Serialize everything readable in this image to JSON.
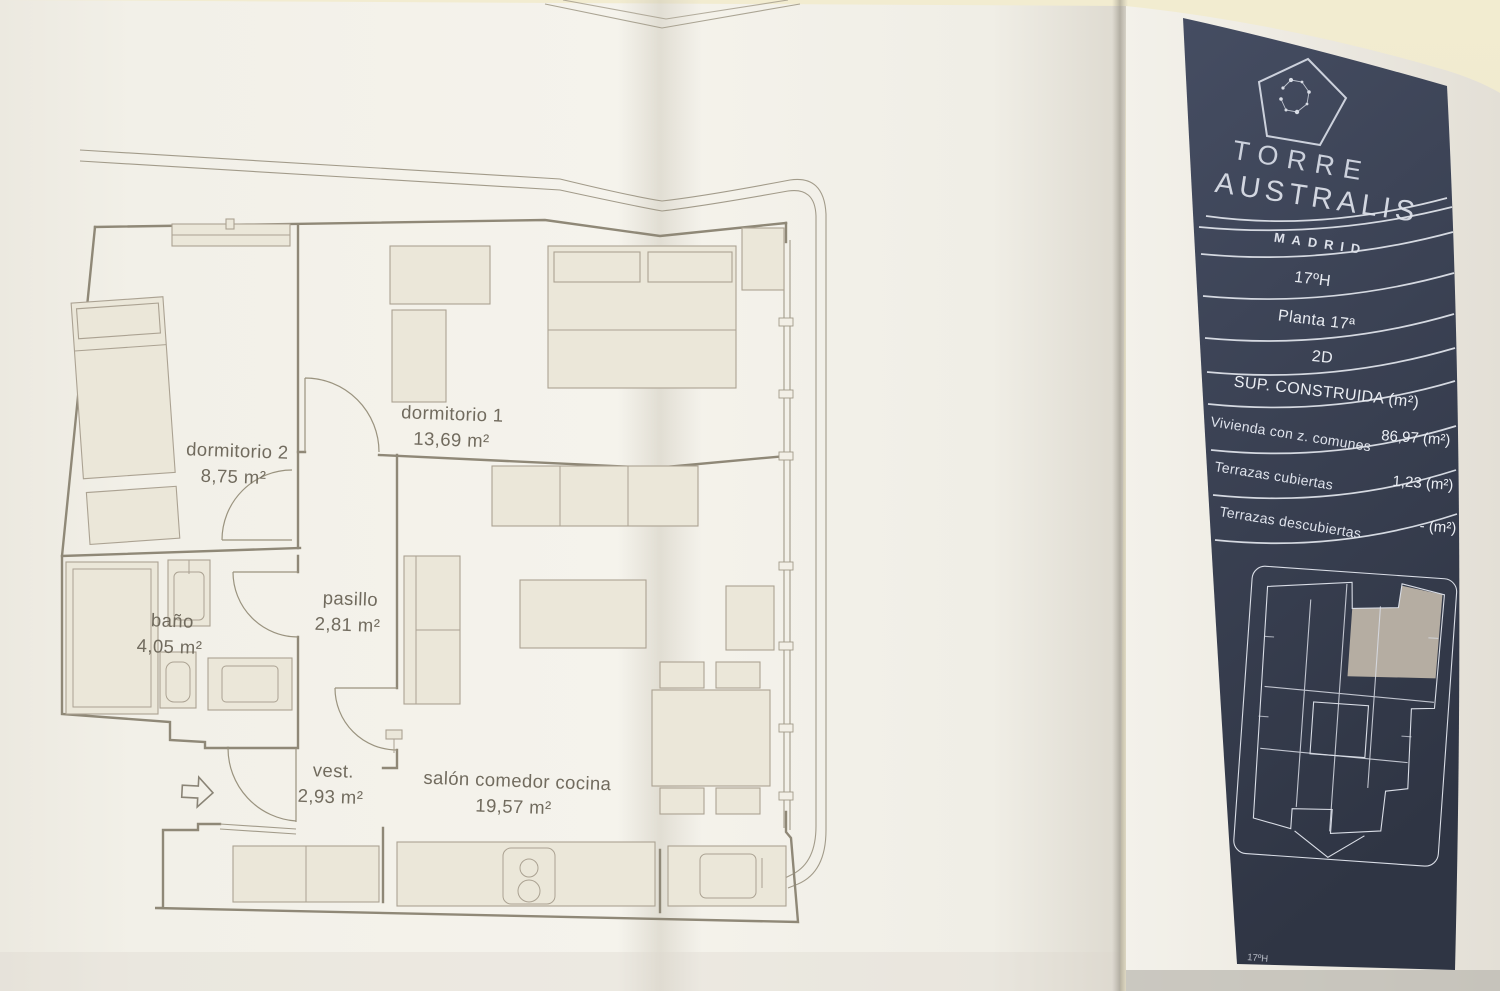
{
  "floorplan": {
    "rooms": [
      {
        "name": "dormitorio 1",
        "area": "13,69 m²"
      },
      {
        "name": "dormitorio 2",
        "area": "8,75 m²"
      },
      {
        "name": "baño",
        "area": "4,05 m²"
      },
      {
        "name": "pasillo",
        "area": "2,81 m²"
      },
      {
        "name": "vest.",
        "area": "2,93 m²"
      },
      {
        "name": "salón comedor cocina",
        "area": "19,57 m²"
      }
    ]
  },
  "panel": {
    "brand_line1": "TORRE",
    "brand_line2": "AUSTRALIS",
    "brand_city": "MADRID",
    "unit_code": "17ºH",
    "floor": "Planta 17ª",
    "unit_type": "2D",
    "surface_header": "SUP. CONSTRUIDA (m²)",
    "surface_rows": [
      {
        "label": "Vivienda con z. comunes",
        "value": "86,97 (m²)"
      },
      {
        "label": "Terrazas cubiertas",
        "value": "1,23 (m²)"
      },
      {
        "label": "Terrazas descubiertas",
        "value": "- (m²)"
      }
    ],
    "footer_code": "17ºH"
  },
  "icons": {
    "logo": "pentagon-constellation-logo",
    "entrance": "entrance-arrow"
  },
  "colors": {
    "panel_navy": "#3b4254",
    "paper": "#f4f2eb",
    "cream": "#efe9cd",
    "plan_line": "#8f8877",
    "highlight_unit": "#b5ada2"
  }
}
